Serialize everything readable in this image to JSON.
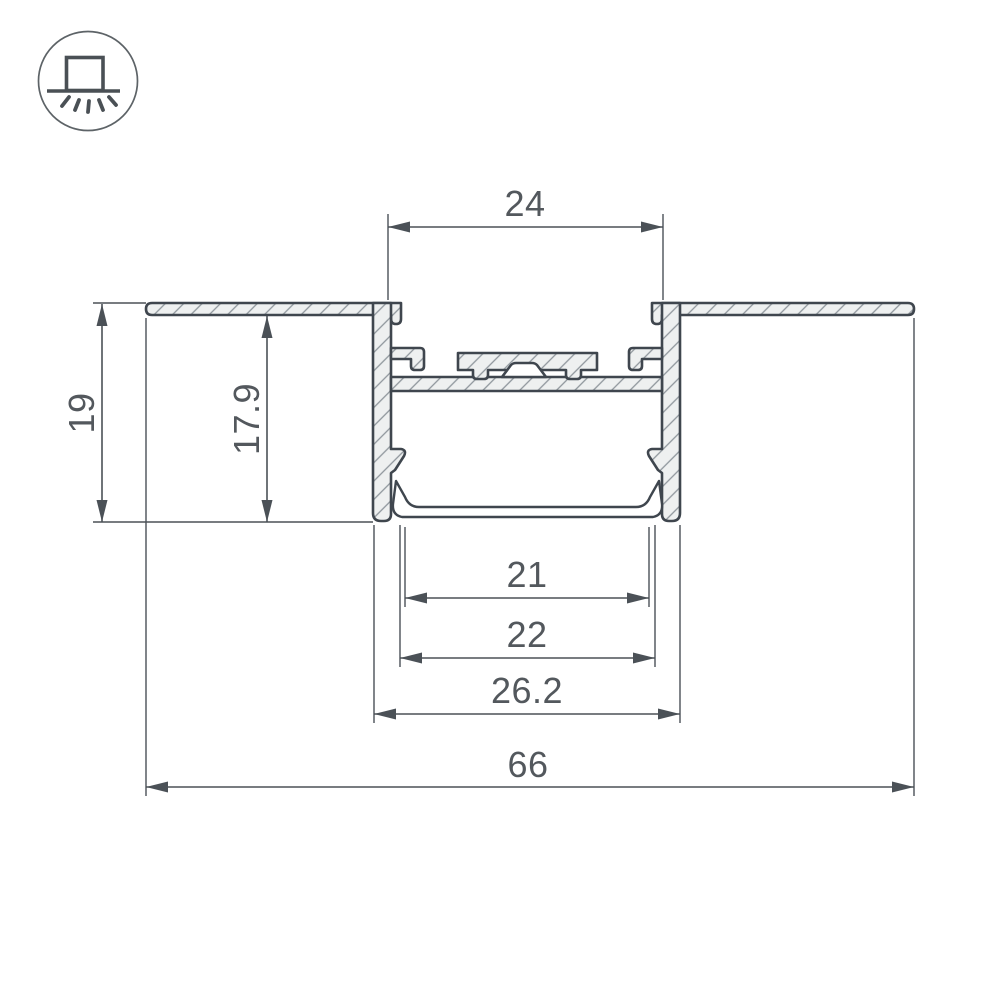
{
  "icon": {
    "name": "recessed-downlight-icon",
    "rays": 5
  },
  "colors": {
    "background": "#ffffff",
    "outline": "#3f464e",
    "metal_fill": "#eef0f0",
    "hatch": "#8f969c",
    "dim_line": "#4b5157",
    "dim_text": "#53585d",
    "icon_stroke": "#4a5055",
    "icon_circle": "#5d6367"
  },
  "drawing": {
    "type": "profile-cross-section",
    "units": "mm",
    "dimensions": [
      {
        "id": "24",
        "value": "24",
        "orientation": "horizontal",
        "x1": 388,
        "x2": 663,
        "y": 227,
        "tx": 525,
        "ty": 216,
        "ext": [
          [
            388,
            214,
            388,
            300
          ],
          [
            663,
            214,
            663,
            300
          ]
        ]
      },
      {
        "id": "19",
        "value": "19",
        "orientation": "vertical",
        "y1": 304,
        "y2": 522,
        "x": 102,
        "tx": 94,
        "ty": 413,
        "ext": [
          [
            93,
            303,
            146,
            303
          ],
          [
            93,
            522,
            373,
            522
          ]
        ]
      },
      {
        "id": "17-9",
        "value": "17.9",
        "orientation": "vertical",
        "y1": 316,
        "y2": 522,
        "x": 267,
        "tx": 259,
        "ty": 419,
        "ext": []
      },
      {
        "id": "21",
        "value": "21",
        "orientation": "horizontal",
        "x1": 405,
        "x2": 649,
        "y": 598,
        "tx": 527,
        "ty": 587,
        "ext": [
          [
            405,
            527,
            405,
            607
          ],
          [
            649,
            527,
            649,
            607
          ]
        ]
      },
      {
        "id": "22",
        "value": "22",
        "orientation": "horizontal",
        "x1": 400,
        "x2": 655,
        "y": 658,
        "tx": 527,
        "ty": 647,
        "ext": [
          [
            400,
            525,
            400,
            667
          ],
          [
            655,
            525,
            655,
            667
          ]
        ]
      },
      {
        "id": "26-2",
        "value": "26.2",
        "orientation": "horizontal",
        "x1": 374,
        "x2": 680,
        "y": 714,
        "tx": 527,
        "ty": 703,
        "ext": [
          [
            374,
            525,
            374,
            723
          ],
          [
            680,
            525,
            680,
            723
          ]
        ]
      },
      {
        "id": "66",
        "value": "66",
        "orientation": "horizontal",
        "x1": 146,
        "x2": 914,
        "y": 787,
        "tx": 528,
        "ty": 777,
        "ext": [
          [
            146,
            318,
            146,
            796
          ],
          [
            914,
            318,
            914,
            796
          ]
        ]
      }
    ]
  }
}
